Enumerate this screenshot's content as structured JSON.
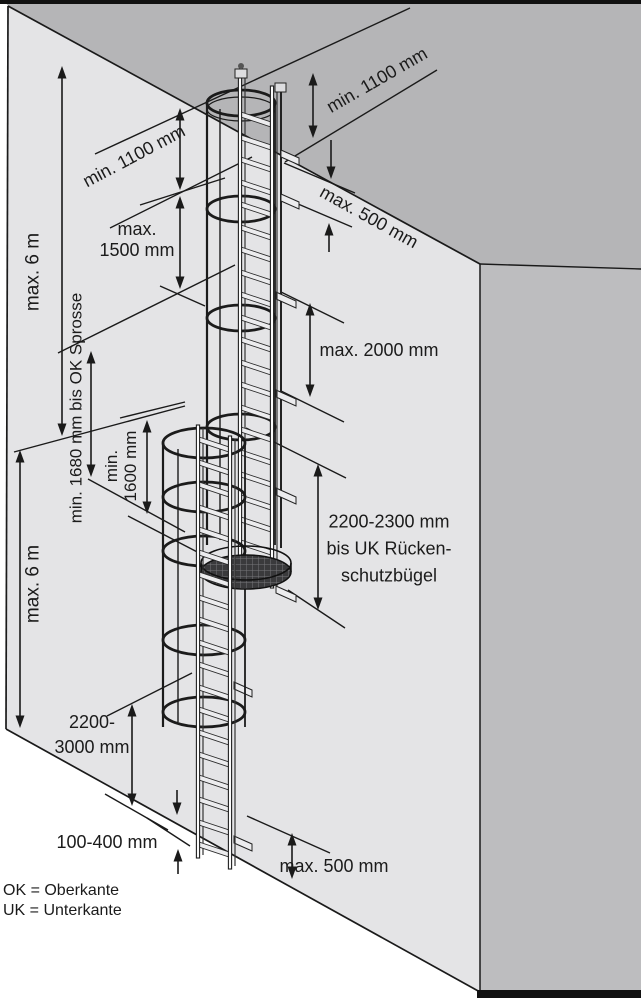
{
  "diagram": {
    "labels": {
      "max_6m_upper": "max. 6 m",
      "max_6m_lower": "max. 6 m",
      "min_1100_left": "min. 1100 mm",
      "min_1100_right": "min. 1100 mm",
      "max_500_top": "max. 500 mm",
      "max_1500_l1": "max.",
      "max_1500_l2": "1500 mm",
      "max_2000": "max. 2000 mm",
      "min_1680": "min. 1680 mm bis OK Sprosse",
      "min_1600_l1": "min.",
      "min_1600_l2": "1600 mm",
      "dist_2200_2300_l1": "2200-2300 mm",
      "dist_2200_2300_l2": "bis UK Rücken-",
      "dist_2200_2300_l3": "schutzbügel",
      "dist_2200_3000_l1": "2200-",
      "dist_2200_3000_l2": "3000 mm",
      "dist_100_400": "100-400 mm",
      "max_500_bottom": "max. 500 mm",
      "legend_ok": "OK = Oberkante",
      "legend_uk": "UK = Unterkante"
    },
    "colors": {
      "front_wall": "#e4e4e6",
      "roof": "#b5b5b7",
      "side_wall": "#bdbdbf",
      "line": "#1a1a1a",
      "platform": "#3a3a3c"
    }
  }
}
